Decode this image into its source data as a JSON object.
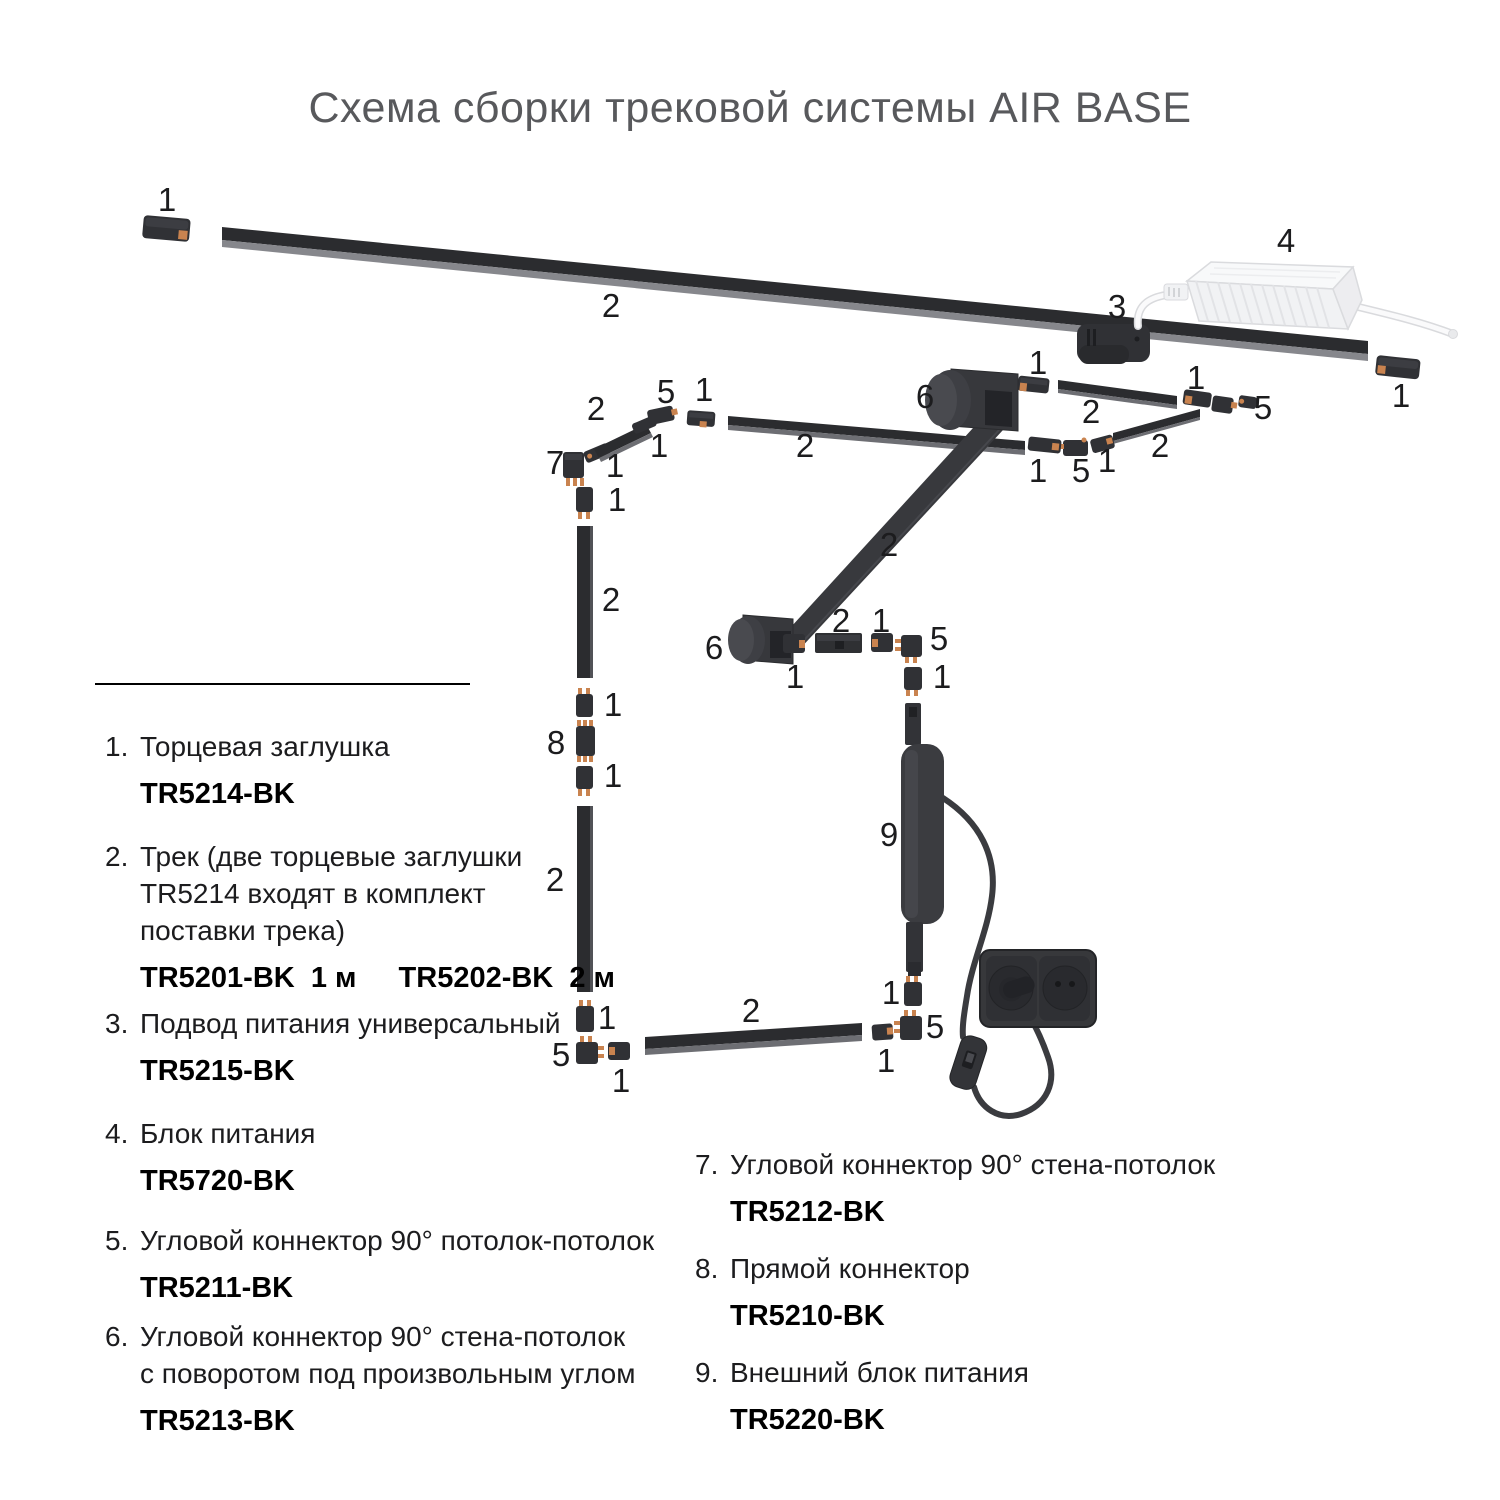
{
  "title": "Схема сборки трековой системы AIR BASE",
  "colors": {
    "track": "#2b2c2f",
    "track_bevel": "#86878c",
    "connector": "#303135",
    "contact_copper": "#c9834f",
    "psu_white": "#f4f5f7",
    "cable_dark": "#3a3b3f",
    "title_gray": "#58595c",
    "text": "#1c1c1e"
  },
  "diagram": {
    "callouts": [
      {
        "t": "1",
        "x": 167,
        "y": 211
      },
      {
        "t": "2",
        "x": 611,
        "y": 317
      },
      {
        "t": "3",
        "x": 1117,
        "y": 318
      },
      {
        "t": "4",
        "x": 1286,
        "y": 252
      },
      {
        "t": "1",
        "x": 1401,
        "y": 407
      },
      {
        "t": "1",
        "x": 1038,
        "y": 374
      },
      {
        "t": "2",
        "x": 1091,
        "y": 423
      },
      {
        "t": "1",
        "x": 1196,
        "y": 389
      },
      {
        "t": "5",
        "x": 1263,
        "y": 419
      },
      {
        "t": "2",
        "x": 1160,
        "y": 457
      },
      {
        "t": "1",
        "x": 1107,
        "y": 472
      },
      {
        "t": "5",
        "x": 1081,
        "y": 482
      },
      {
        "t": "1",
        "x": 1038,
        "y": 482
      },
      {
        "t": "6",
        "x": 925,
        "y": 408
      },
      {
        "t": "2",
        "x": 889,
        "y": 556
      },
      {
        "t": "6",
        "x": 714,
        "y": 659
      },
      {
        "t": "1",
        "x": 795,
        "y": 688
      },
      {
        "t": "2",
        "x": 841,
        "y": 632
      },
      {
        "t": "1",
        "x": 881,
        "y": 632
      },
      {
        "t": "5",
        "x": 939,
        "y": 650
      },
      {
        "t": "1",
        "x": 942,
        "y": 688
      },
      {
        "t": "9",
        "x": 889,
        "y": 846
      },
      {
        "t": "1",
        "x": 891,
        "y": 1004
      },
      {
        "t": "5",
        "x": 935,
        "y": 1038
      },
      {
        "t": "1",
        "x": 886,
        "y": 1072
      },
      {
        "t": "7",
        "x": 555,
        "y": 474
      },
      {
        "t": "1",
        "x": 615,
        "y": 477
      },
      {
        "t": "1",
        "x": 617,
        "y": 511
      },
      {
        "t": "2",
        "x": 611,
        "y": 611
      },
      {
        "t": "1",
        "x": 613,
        "y": 716
      },
      {
        "t": "8",
        "x": 556,
        "y": 754
      },
      {
        "t": "1",
        "x": 613,
        "y": 787
      },
      {
        "t": "2",
        "x": 555,
        "y": 891
      },
      {
        "t": "1",
        "x": 607,
        "y": 1029
      },
      {
        "t": "5",
        "x": 561,
        "y": 1066
      },
      {
        "t": "1",
        "x": 621,
        "y": 1092
      },
      {
        "t": "2",
        "x": 751,
        "y": 1022
      },
      {
        "t": "5",
        "x": 666,
        "y": 403
      },
      {
        "t": "1",
        "x": 704,
        "y": 401
      },
      {
        "t": "2",
        "x": 596,
        "y": 420
      },
      {
        "t": "1",
        "x": 659,
        "y": 457
      },
      {
        "t": "2",
        "x": 805,
        "y": 457
      }
    ]
  },
  "legend": {
    "left": [
      {
        "num": "1.",
        "lines": [
          "Торцевая заглушка"
        ],
        "codes": [
          "TR5214-BK"
        ]
      },
      {
        "num": "2.",
        "lines": [
          "Трек (две торцевые заглушки",
          "TR5214 входят в комплект",
          "поставки трека)"
        ],
        "codes": [
          "TR5201-BK  1 м",
          "TR5202-BK  2 м"
        ]
      },
      {
        "num": "3.",
        "lines": [
          "Подвод питания универсальный"
        ],
        "codes": [
          "TR5215-BK"
        ]
      },
      {
        "num": "4.",
        "lines": [
          "Блок питания"
        ],
        "codes": [
          "TR5720-BK"
        ]
      },
      {
        "num": "5.",
        "lines": [
          "Угловой коннектор 90° потолок-потолок"
        ],
        "codes": [
          "TR5211-BK"
        ]
      },
      {
        "num": "6.",
        "lines": [
          "Угловой коннектор 90° стена-потолок",
          "с поворотом под произвольным углом"
        ],
        "codes": [
          "TR5213-BK"
        ]
      }
    ],
    "right": [
      {
        "num": "7.",
        "lines": [
          "Угловой коннектор 90° стена-потолок"
        ],
        "codes": [
          "TR5212-BK"
        ]
      },
      {
        "num": "8.",
        "lines": [
          "Прямой коннектор"
        ],
        "codes": [
          "TR5210-BK"
        ]
      },
      {
        "num": "9.",
        "lines": [
          "Внешний блок питания"
        ],
        "codes": [
          "TR5220-BK"
        ]
      }
    ]
  }
}
